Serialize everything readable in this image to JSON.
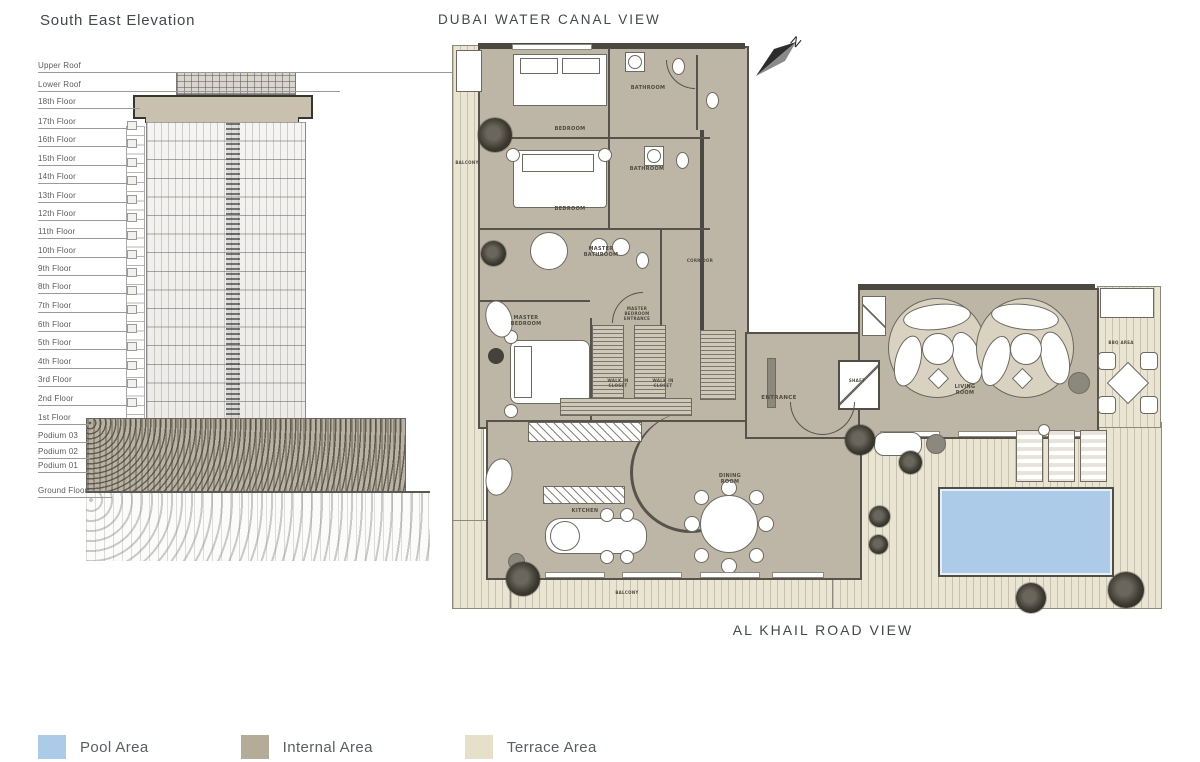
{
  "elevation": {
    "title": "South East Elevation",
    "floors": [
      "Upper Roof",
      "Lower Roof",
      "18th Floor",
      "17th Floor",
      "16th Floor",
      "15th Floor",
      "14th Floor",
      "13th Floor",
      "12th Floor",
      "11th Floor",
      "10th Floor",
      "9th Floor",
      "8th Floor",
      "7th Floor",
      "6th Floor",
      "5th Floor",
      "4th Floor",
      "3rd Floor",
      "2nd Floor",
      "1st Floor",
      "Podium 03",
      "Podium 02",
      "Podium 01",
      "Ground Floor"
    ]
  },
  "plan": {
    "top_view_label": "DUBAI WATER CANAL VIEW",
    "bottom_view_label": "AL KHAIL ROAD VIEW",
    "north_indicator": "N",
    "rooms": {
      "bedroom1": "BEDROOM",
      "bathroom1": "BATHROOM",
      "bedroom2": "BEDROOM",
      "bathroom2": "BATHROOM",
      "master_bathroom": "MASTER BATHROOM",
      "corridor": "CORRIDOR",
      "master_bedroom": "MASTER BEDROOM",
      "master_bedroom_entrance": "MASTER BEDROOM ENTRANCE",
      "walk_in_closet_1": "WALK IN CLOSET",
      "walk_in_closet_2": "WALK IN CLOSET",
      "entrance": "ENTRANCE",
      "living_room": "LIVING ROOM",
      "kitchen": "KITCHEN",
      "dining_room": "DINING ROOM",
      "balcony_left": "BALCONY",
      "balcony_bottom": "BALCONY",
      "bbq_area": "BBQ AREA",
      "shaft": "SHAFT"
    }
  },
  "legend": {
    "items": [
      {
        "label": "Pool Area",
        "color": "#abcbe8"
      },
      {
        "label": "Internal Area",
        "color": "#b4ab99"
      },
      {
        "label": "Terrace Area",
        "color": "#e6e0cb"
      }
    ]
  },
  "colors": {
    "wall": "#57534c",
    "internal_fill": "#bdb5a5",
    "terrace_fill": "#eae4d3",
    "pool_fill": "#abcbe8"
  }
}
